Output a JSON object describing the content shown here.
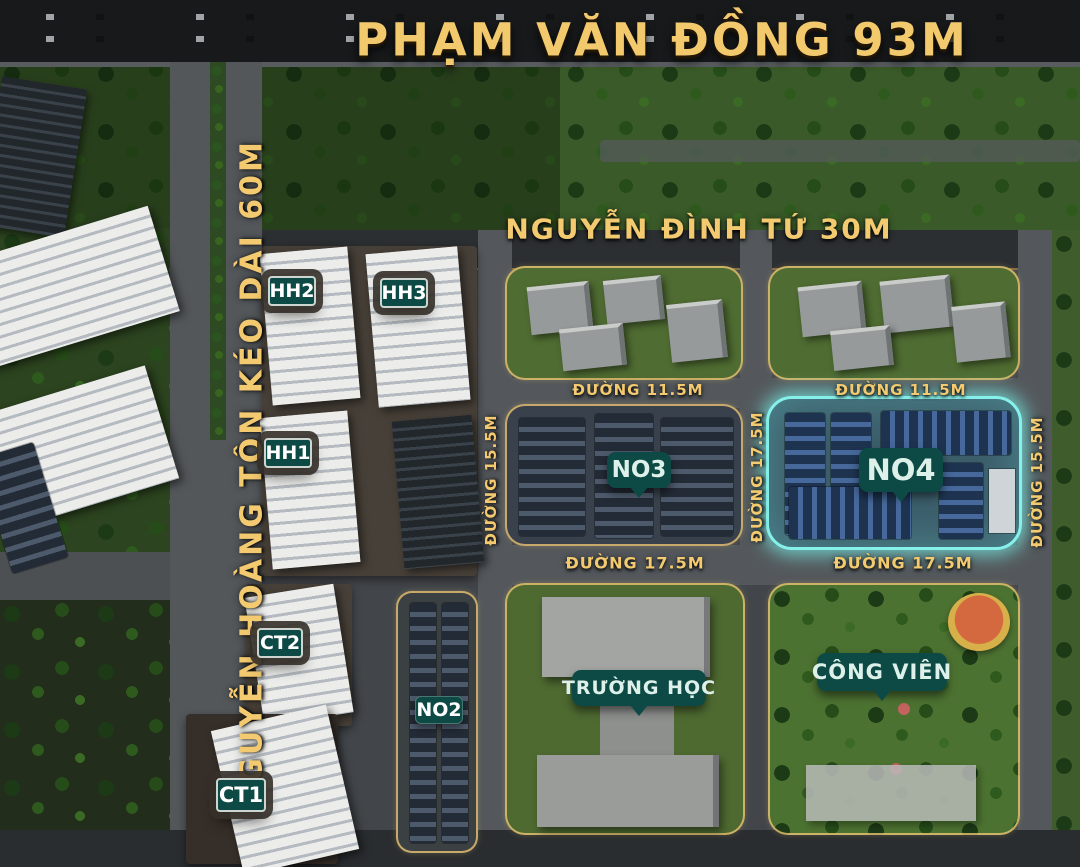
{
  "streets": {
    "pham_van_dong": "PHẠM VĂN ĐỒNG 93M",
    "nguyen_hoang_ton": "NGUYỄN HOÀNG TÔN KÉO DÀI 60M",
    "nguyen_dinh_tu": "NGUYỄN ĐÌNH TỨ 30M",
    "duong_11_5": "ĐƯỜNG 11.5M",
    "duong_15_5": "ĐƯỜNG 15.5M",
    "duong_17_5": "ĐƯỜNG 17.5M"
  },
  "blocks": {
    "hh1": "HH1",
    "hh2": "HH2",
    "hh3": "HH3",
    "ct1": "CT1",
    "ct2": "CT2",
    "no2": "NO2",
    "no3": "NO3",
    "no4": "NO4",
    "school": "TRƯỜNG HỌC",
    "park": "CÔNG VIÊN"
  },
  "highlight": {
    "block": "NO4",
    "color": "#86f1ea"
  },
  "colors": {
    "street_text": "#f3ca70",
    "label_bg": "#0e4a45",
    "label_text": "#ffffff",
    "highlight_glow": "#86f1ea"
  }
}
